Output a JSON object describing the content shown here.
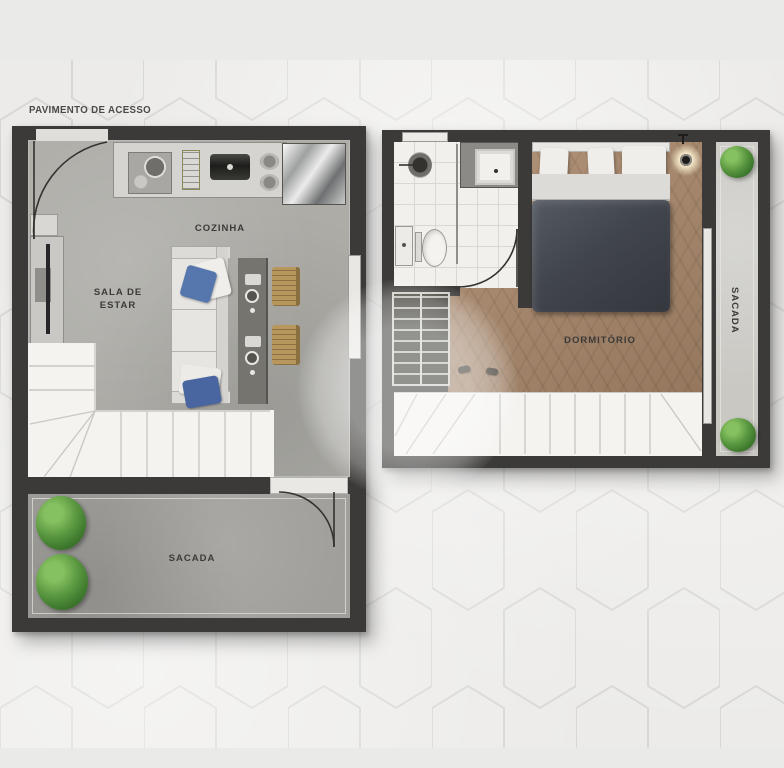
{
  "page": {
    "title": "PAVIMENTO DE ACESSO"
  },
  "access_floor": {
    "kitchen_label": "COZINHA",
    "living_label_line1": "SALA DE",
    "living_label_line2": "ESTAR",
    "balcony_label": "SACADA"
  },
  "upper_floor": {
    "bedroom_label": "DORMITÓRIO",
    "balcony_label": "SACADA"
  },
  "colors": {
    "wall": "#3b3a38",
    "concrete_floor": "#adaca7",
    "balcony_floor": "#a09f9b",
    "wood_floor": "#a9886b",
    "tile_floor": "#f1f0ec",
    "stair_white": "#f4f3f0",
    "plant_green": "#4e8a3c",
    "duvet_gray": "#45484e",
    "pillow_blue": "#5577ad",
    "chair_wood": "#b8975e",
    "label_text": "#3b3a38",
    "background": "#e9e9e7",
    "hex_line": "#d8d7d3"
  }
}
